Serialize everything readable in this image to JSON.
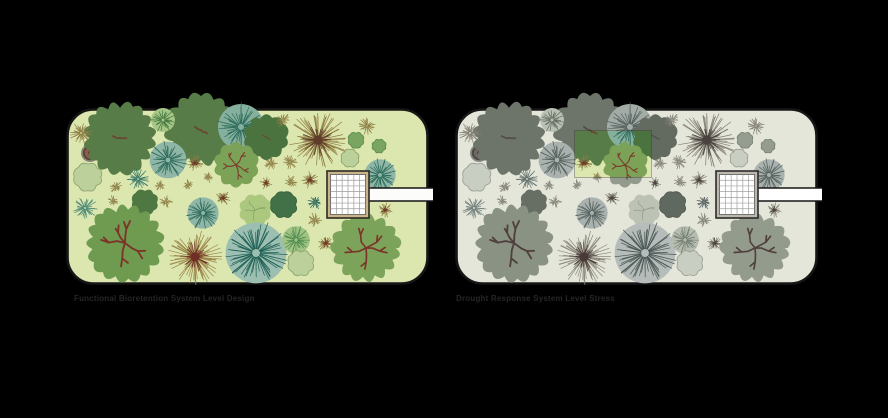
{
  "figure": {
    "background": "#000000",
    "left_panel": {
      "caption": "Functional Bioretention System Level Design"
    },
    "right_panel": {
      "caption": "Drought Response System Level Stress",
      "desaturated": true,
      "highlight_patch": {
        "x": 120,
        "y": 23,
        "w": 76,
        "h": 46
      }
    }
  },
  "garden": {
    "w": 360,
    "h": 174,
    "radius": 26,
    "bg": "#dce6af",
    "border": "#161616",
    "border_w": 2.6,
    "building": {
      "x": 261,
      "y": 63,
      "w": 42,
      "h": 47,
      "cols": 6,
      "rows": 7,
      "frame": "#c9b389",
      "frame_stroke": "#2e2a24",
      "cell": "#ffffff",
      "grid": "#9b9b9b"
    },
    "path": {
      "x": 296,
      "y": 80,
      "w": 71,
      "h": 13,
      "fill": "#fcfcfa",
      "edge": "#141414"
    },
    "well": {
      "x": 24,
      "y": 45,
      "r": 9,
      "ring": "#8c8579",
      "rim": "#5d4338",
      "fill": "#8a5f46",
      "dot": "#4e352b"
    },
    "plants": [
      {
        "t": "canopy",
        "x": 54,
        "y": 30,
        "r": 35,
        "f": "#577c48",
        "b": "#6b4632",
        "bm": "small"
      },
      {
        "t": "canopy",
        "x": 135,
        "y": 22,
        "r": 35,
        "f": "#577c48",
        "b": "#6b4632",
        "bm": "small"
      },
      {
        "t": "radial",
        "x": 97,
        "y": 12,
        "r": 13,
        "f": "#a5c687",
        "s": "#43773f"
      },
      {
        "t": "radial",
        "x": 175,
        "y": 19,
        "r": 25,
        "f": "#86b09e",
        "s": "#2e6b5b"
      },
      {
        "t": "canopy",
        "x": 200,
        "y": 29,
        "r": 22,
        "f": "#4a7340",
        "b": "#6b4632",
        "bm": "small"
      },
      {
        "t": "burst",
        "x": 15,
        "y": 25,
        "r": 12,
        "s": "#8d7f45"
      },
      {
        "t": "burst",
        "x": 217,
        "y": 12,
        "r": 8,
        "s": "#8d7f45"
      },
      {
        "t": "burst",
        "x": 301,
        "y": 18,
        "r": 9,
        "s": "#8d7f45"
      },
      {
        "t": "burst",
        "x": 252,
        "y": 32,
        "r": 30,
        "s": "#8f7c42",
        "d": "#5f3c2a"
      },
      {
        "t": "circle",
        "x": 290,
        "y": 32,
        "r": 8,
        "f": "#79a561",
        "s": "#5c8a4a"
      },
      {
        "t": "circle",
        "x": 313,
        "y": 38,
        "r": 7,
        "f": "#79a561",
        "s": "#5c8a4a"
      },
      {
        "t": "shrub",
        "x": 284,
        "y": 50,
        "r": 9,
        "f": "#bcd09b",
        "s": "#8aa06b"
      },
      {
        "t": "shrub",
        "x": 22,
        "y": 69,
        "r": 14,
        "f": "#bcd09b",
        "s": "#8aa06b"
      },
      {
        "t": "radial",
        "x": 102,
        "y": 52,
        "r": 20,
        "f": "#8fb6a6",
        "s": "#2e6b5b"
      },
      {
        "t": "burst",
        "x": 129,
        "y": 55,
        "r": 9,
        "s": "#8d7f45",
        "d": "#6f3b28"
      },
      {
        "t": "canopy",
        "x": 170,
        "y": 57,
        "r": 22,
        "f": "#7ca257",
        "b": "#7b3a2c",
        "bm": "full"
      },
      {
        "t": "burst",
        "x": 205,
        "y": 55,
        "r": 7,
        "s": "#8d7f45"
      },
      {
        "t": "burst",
        "x": 224,
        "y": 54,
        "r": 8,
        "s": "#8d7f45"
      },
      {
        "t": "burst",
        "x": 244,
        "y": 72,
        "r": 9,
        "s": "#8d7f45",
        "d": "#6f3b28"
      },
      {
        "t": "burst",
        "x": 72,
        "y": 71,
        "r": 12,
        "s": "#3a7b6a"
      },
      {
        "t": "burst",
        "x": 50,
        "y": 79,
        "r": 7,
        "s": "#8d7f45"
      },
      {
        "t": "burst",
        "x": 94,
        "y": 77,
        "r": 6,
        "s": "#8d7f45"
      },
      {
        "t": "burst",
        "x": 122,
        "y": 77,
        "r": 6,
        "s": "#8d7f45"
      },
      {
        "t": "burst",
        "x": 142,
        "y": 69,
        "r": 6,
        "s": "#8d7f45"
      },
      {
        "t": "burst",
        "x": 200,
        "y": 75,
        "r": 7,
        "s": "#8d7f45",
        "d": "#6f3b28"
      },
      {
        "t": "burst",
        "x": 225,
        "y": 74,
        "r": 7,
        "s": "#8d7f45"
      },
      {
        "t": "radial",
        "x": 314,
        "y": 67,
        "r": 17,
        "f": "#8fb6a6",
        "s": "#2e6b5b"
      },
      {
        "t": "burst",
        "x": 319,
        "y": 102,
        "r": 8,
        "s": "#8d7f45",
        "d": "#6f3b28"
      },
      {
        "t": "burst",
        "x": 289,
        "y": 107,
        "r": 8,
        "s": "#8d7f45",
        "d": "#6f3b28"
      },
      {
        "t": "canopy",
        "x": 79,
        "y": 94,
        "r": 13,
        "f": "#4e7742"
      },
      {
        "t": "burst",
        "x": 100,
        "y": 94,
        "r": 7,
        "s": "#8d7f45"
      },
      {
        "t": "burst",
        "x": 47,
        "y": 93,
        "r": 6,
        "s": "#8d7f45"
      },
      {
        "t": "burst",
        "x": 157,
        "y": 90,
        "r": 8,
        "s": "#8d7f45",
        "d": "#6f3b28"
      },
      {
        "t": "radial",
        "x": 137,
        "y": 105,
        "r": 17,
        "f": "#8fb6a6",
        "s": "#2e6b5b"
      },
      {
        "t": "canopy",
        "x": 189,
        "y": 102,
        "r": 16,
        "f": "#abc87e",
        "b": "#87a468",
        "bm": "thin"
      },
      {
        "t": "circle",
        "x": 218,
        "y": 97,
        "r": 13,
        "f": "#427147",
        "s": "#35603c"
      },
      {
        "t": "burst",
        "x": 249,
        "y": 94,
        "r": 8,
        "s": "#2c685c"
      },
      {
        "t": "burst",
        "x": 249,
        "y": 112,
        "r": 8,
        "s": "#8d7f45"
      },
      {
        "t": "burst",
        "x": 19,
        "y": 100,
        "r": 13,
        "s": "#4d8a78"
      },
      {
        "t": "canopy",
        "x": 59,
        "y": 135,
        "r": 37,
        "f": "#6f9b51",
        "b": "#7c3328",
        "bm": "full"
      },
      {
        "t": "burst",
        "x": 129,
        "y": 149,
        "r": 28,
        "s": "#9a8648",
        "d": "#6f2f24"
      },
      {
        "t": "radial",
        "x": 190,
        "y": 145,
        "r": 33,
        "f": "#9dbfb2",
        "s": "#1f6055"
      },
      {
        "t": "radial",
        "x": 230,
        "y": 132,
        "r": 15,
        "f": "#9fc383",
        "s": "#4e8a4e"
      },
      {
        "t": "shrub",
        "x": 235,
        "y": 155,
        "r": 13,
        "f": "#bcd09b",
        "s": "#8aa06b"
      },
      {
        "t": "burst",
        "x": 260,
        "y": 135,
        "r": 9,
        "s": "#8d7f45",
        "d": "#6f3b28"
      },
      {
        "t": "canopy",
        "x": 300,
        "y": 140,
        "r": 33,
        "f": "#7ba35a",
        "b": "#7c3328",
        "bm": "full"
      }
    ]
  }
}
